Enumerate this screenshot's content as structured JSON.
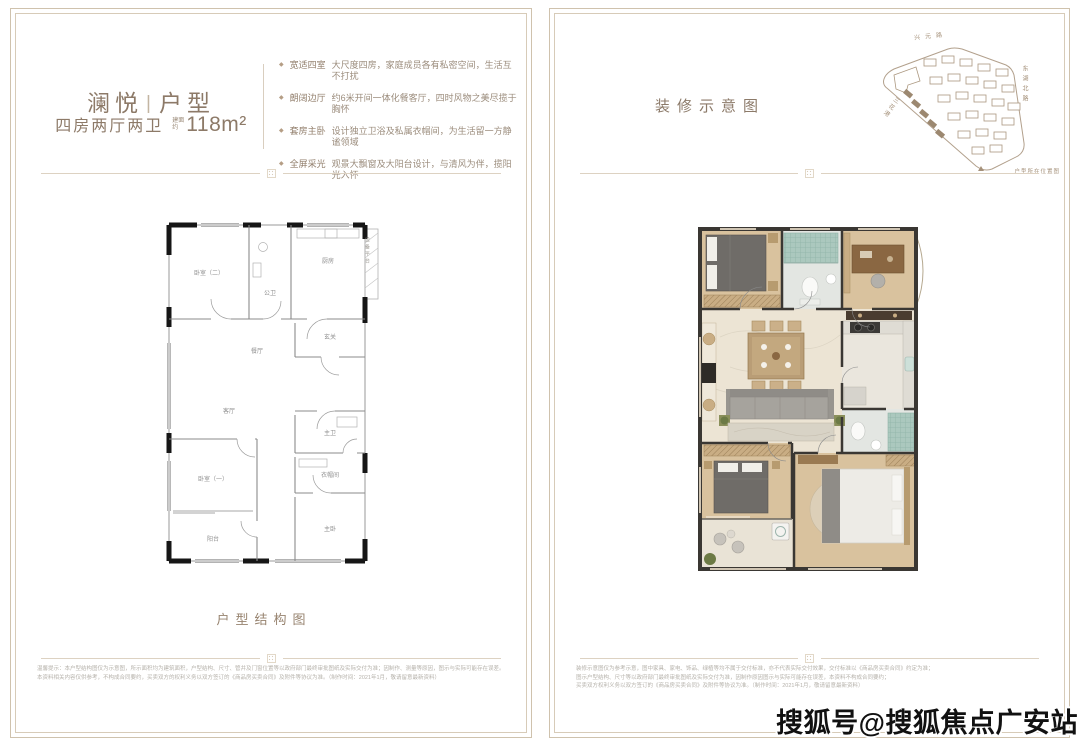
{
  "icons": {
    "feature_bullet": "◆"
  },
  "left_page": {
    "title": {
      "part1": "澜悦",
      "divider": "|",
      "part2": "户型"
    },
    "subtitle": {
      "layout": "四房两厅两卫",
      "area_prefix_line1": "建面",
      "area_prefix_line2": "约",
      "area": "118m²"
    },
    "features": [
      {
        "tag": "宽适四室",
        "desc": "大尺度四房，家庭成员各有私密空间，生活互不打扰"
      },
      {
        "tag": "朗阔边厅",
        "desc": "约6米开间一体化餐客厅，四时风物之美尽揽于胸怀"
      },
      {
        "tag": "套房主卧",
        "desc": "设计独立卫浴及私属衣帽间，为生活留一方静谧领域"
      },
      {
        "tag": "全屏采光",
        "desc": "观景大飘窗及大阳台设计，与清风为伴，揽阳光入怀"
      }
    ],
    "plan": {
      "caption": "户型结构图",
      "rooms": {
        "bedroom2": "卧室（二）",
        "bath_public": "公卫",
        "kitchen": "厨房",
        "equipment": "设备平台",
        "entry": "玄关",
        "dining": "餐厅",
        "living": "客厅",
        "bath_master": "主卫",
        "cloak": "衣帽间",
        "master": "主卧",
        "bedroom1": "卧室（一）",
        "balcony": "阳台"
      }
    },
    "disclaimer": [
      "温馨提示：本户型结构图仅为示意图，所示面积均为建筑面积，户型结构、尺寸、管井及门窗位置等以政府部门最终审批图纸及实际交付为准；因制作、测量等原因，图示与实际可能存在误差。",
      "本资料相关内容仅供参考，不构成合同要约，买卖双方的权利义务以双方签订的《商品房买卖合同》及附件等协议为准。（制作时间：2021年1月，敬请留意最新资料）"
    ]
  },
  "right_page": {
    "header": "装修示意图",
    "sitemap": {
      "road_top": "兴元路",
      "road_right": "东湖北路",
      "waterway": "三花港",
      "caption": "户型所在位置图"
    },
    "disclaimer": [
      "装修示意图仅为参考示意，图中家具、家电、饰品、绿植等均不属于交付标准，亦不代表实际交付效果，交付标准以《商品房买卖合同》约定为准；",
      "图示户型结构、尺寸等以政府部门最终审批图纸及实际交付为准，因制作原因图示与实际可能存在误差，本资料不构成合同要约；",
      "买卖双方权利义务以双方签订的《商品房买卖合同》及附件等协议为准。（制作时间：2021年1月，敬请留意最新资料）"
    ]
  },
  "watermark": "搜狐号@搜狐焦点广安站",
  "colors": {
    "frame": "#cfc2ad",
    "title": "#8d7a68",
    "feature_text": "#9b8c7c",
    "accent": "#b59e85",
    "wall_dark": "#1a1a1a",
    "wood": "#d9c29e",
    "marble": "#ece4d4",
    "tile_teal": "#a3c2b8"
  }
}
